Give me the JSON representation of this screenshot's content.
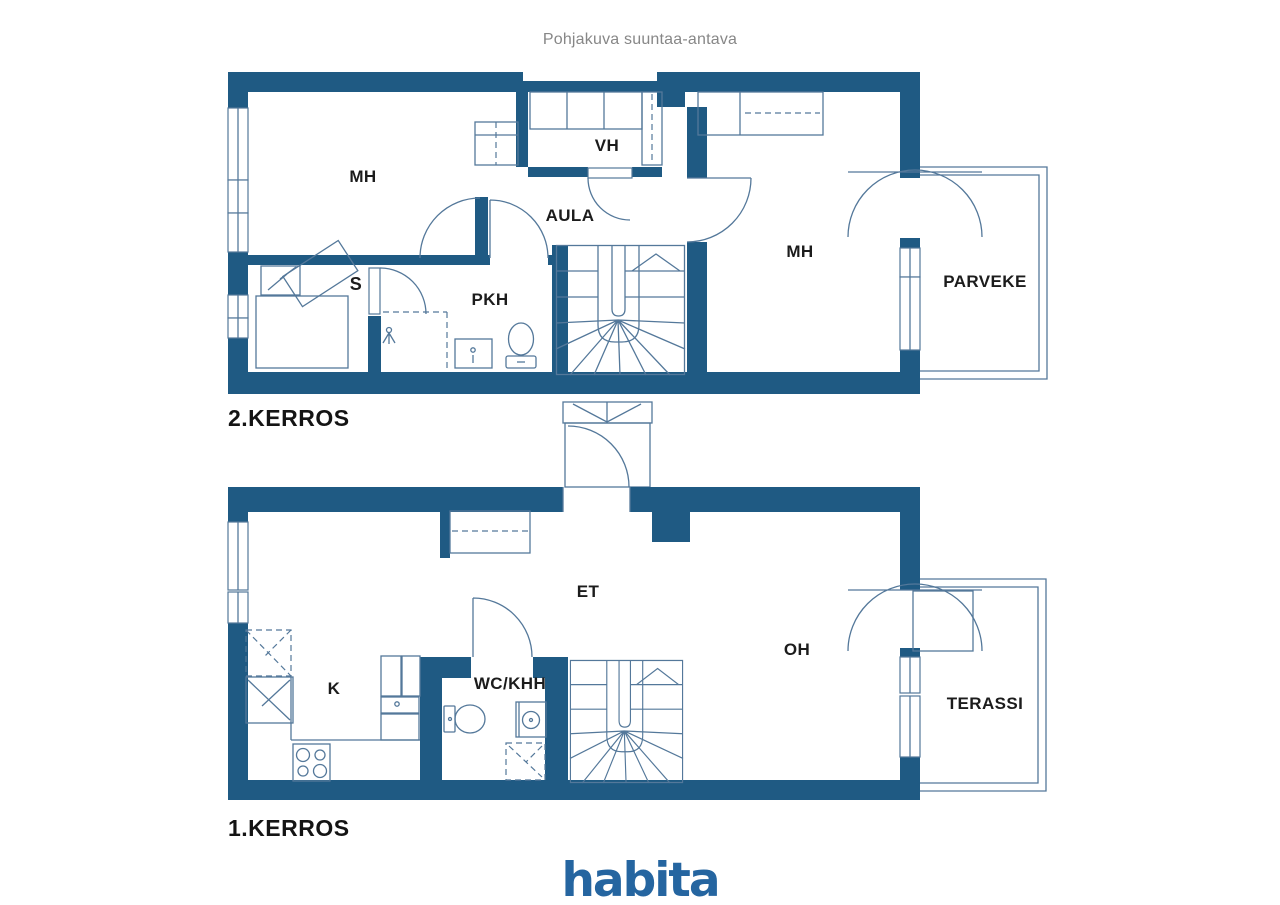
{
  "title": "Pohjakuva suuntaa-antava",
  "floors": [
    {
      "label": "2.KERROS",
      "rooms": [
        {
          "label": "MH"
        },
        {
          "label": "VH"
        },
        {
          "label": "AULA"
        },
        {
          "label": "MH"
        },
        {
          "label": "S"
        },
        {
          "label": "PKH"
        },
        {
          "label": "PARVEKE"
        }
      ]
    },
    {
      "label": "1.KERROS",
      "rooms": [
        {
          "label": "ET"
        },
        {
          "label": "K"
        },
        {
          "label": "WC/KHH"
        },
        {
          "label": "OH"
        },
        {
          "label": "TERASSI"
        }
      ]
    }
  ],
  "brand": {
    "logo_text": "habita"
  },
  "colors": {
    "wall": "#1f5a83",
    "line": "#54789a",
    "label_text": "#1c1c1c",
    "title_text": "#878787",
    "brand_blue": "#2565a0"
  }
}
